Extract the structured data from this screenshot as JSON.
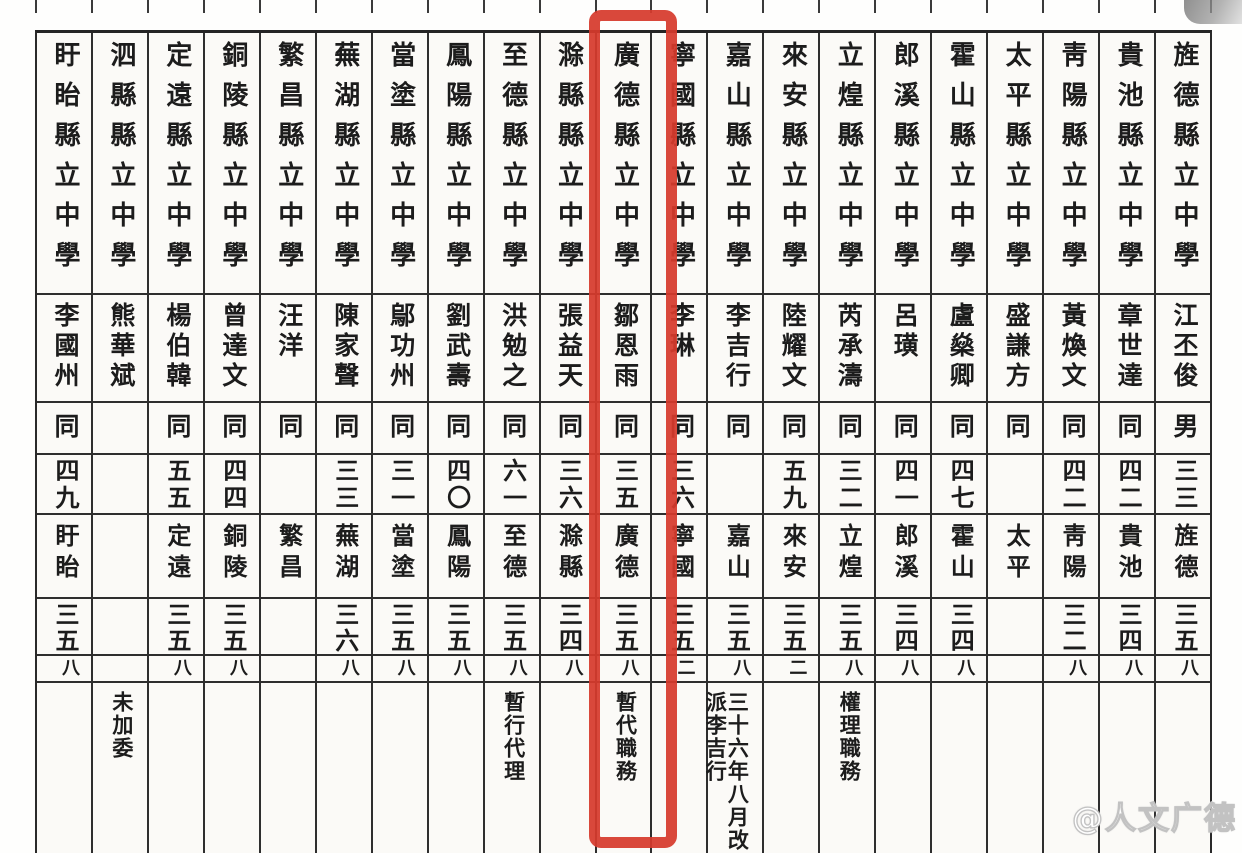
{
  "watermark": {
    "text": "@人文广德"
  },
  "highlight": {
    "color": "#d63a2c",
    "encloses": "廣德縣立中學"
  },
  "table": {
    "reading_direction": "right-to-left vertical text",
    "columns": [
      {
        "school": "盱眙縣立中學",
        "principal": "李國州",
        "sex": "同",
        "age": "四九",
        "place": "盱眙",
        "year": "三五",
        "month": "八",
        "note": ""
      },
      {
        "school": "泗縣縣立中學",
        "principal": "熊華斌",
        "sex": "",
        "age": "",
        "place": "",
        "year": "",
        "month": "",
        "note": "未加委"
      },
      {
        "school": "定遠縣立中學",
        "principal": "楊伯韓",
        "sex": "同",
        "age": "五五",
        "place": "定遠",
        "year": "三五",
        "month": "八",
        "note": ""
      },
      {
        "school": "銅陵縣立中學",
        "principal": "曾達文",
        "sex": "同",
        "age": "四四",
        "place": "銅陵",
        "year": "三五",
        "month": "八",
        "note": ""
      },
      {
        "school": "繁昌縣立中學",
        "principal": "汪洋",
        "sex": "同",
        "age": "",
        "place": "繁昌",
        "year": "",
        "month": "",
        "note": ""
      },
      {
        "school": "蕪湖縣立中學",
        "principal": "陳家聲",
        "sex": "同",
        "age": "三三",
        "place": "蕪湖",
        "year": "三六",
        "month": "八",
        "note": ""
      },
      {
        "school": "當塗縣立中學",
        "principal": "鄔功州",
        "sex": "同",
        "age": "三一",
        "place": "當塗",
        "year": "三五",
        "month": "八",
        "note": ""
      },
      {
        "school": "鳳陽縣立中學",
        "principal": "劉武壽",
        "sex": "同",
        "age": "四〇",
        "place": "鳳陽",
        "year": "三五",
        "month": "八",
        "note": ""
      },
      {
        "school": "至德縣立中學",
        "principal": "洪勉之",
        "sex": "同",
        "age": "六一",
        "place": "至德",
        "year": "三五",
        "month": "八",
        "note": "暫行代理"
      },
      {
        "school": "滁縣縣立中學",
        "principal": "張益天",
        "sex": "同",
        "age": "三六",
        "place": "滁縣",
        "year": "三四",
        "month": "八",
        "note": ""
      },
      {
        "school": "廣德縣立中學",
        "principal": "鄒恩雨",
        "sex": "同",
        "age": "三五",
        "place": "廣德",
        "year": "三五",
        "month": "八",
        "note": "暫代職務"
      },
      {
        "school": "寧國縣立中學",
        "principal": "李琳",
        "sex": "同",
        "age": "三六",
        "place": "寧國",
        "year": "三五",
        "month": "二",
        "note": ""
      },
      {
        "school": "嘉山縣立中學",
        "principal": "李吉行",
        "sex": "同",
        "age": "",
        "place": "嘉山",
        "year": "三五",
        "month": "八",
        "note": "三十六年八月改派李吉行"
      },
      {
        "school": "來安縣立中學",
        "principal": "陸耀文",
        "sex": "同",
        "age": "五九",
        "place": "來安",
        "year": "三五",
        "month": "二",
        "note": ""
      },
      {
        "school": "立煌縣立中學",
        "principal": "芮承濤",
        "sex": "同",
        "age": "三二",
        "place": "立煌",
        "year": "三五",
        "month": "八",
        "note": "權理職務"
      },
      {
        "school": "郎溪縣立中學",
        "principal": "呂璜",
        "sex": "同",
        "age": "四一",
        "place": "郎溪",
        "year": "三四",
        "month": "八",
        "note": ""
      },
      {
        "school": "霍山縣立中學",
        "principal": "盧燊卿",
        "sex": "同",
        "age": "四七",
        "place": "霍山",
        "year": "三四",
        "month": "八",
        "note": ""
      },
      {
        "school": "太平縣立中學",
        "principal": "盛謙方",
        "sex": "同",
        "age": "",
        "place": "太平",
        "year": "",
        "month": "",
        "note": ""
      },
      {
        "school": "靑陽縣立中學",
        "principal": "黃煥文",
        "sex": "同",
        "age": "四二",
        "place": "靑陽",
        "year": "三二",
        "month": "八",
        "note": ""
      },
      {
        "school": "貴池縣立中學",
        "principal": "章世達",
        "sex": "同",
        "age": "四二",
        "place": "貴池",
        "year": "三四",
        "month": "八",
        "note": ""
      },
      {
        "school": "旌德縣立中學",
        "principal": "江丕俊",
        "sex": "男",
        "age": "三三",
        "place": "旌德",
        "year": "三五",
        "month": "八",
        "note": ""
      }
    ]
  }
}
